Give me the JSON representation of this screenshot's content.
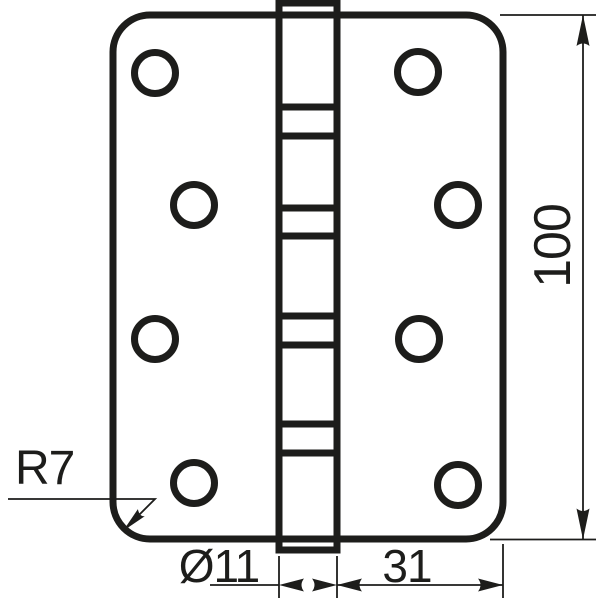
{
  "drawing": {
    "ink_color": "#1d1d1b",
    "background_color": "#ffffff",
    "dimensions": {
      "height_label": "100",
      "corner_radius_label": "R7",
      "barrel_diameter_label": "Ø11",
      "leaf_width_label": "31"
    }
  }
}
